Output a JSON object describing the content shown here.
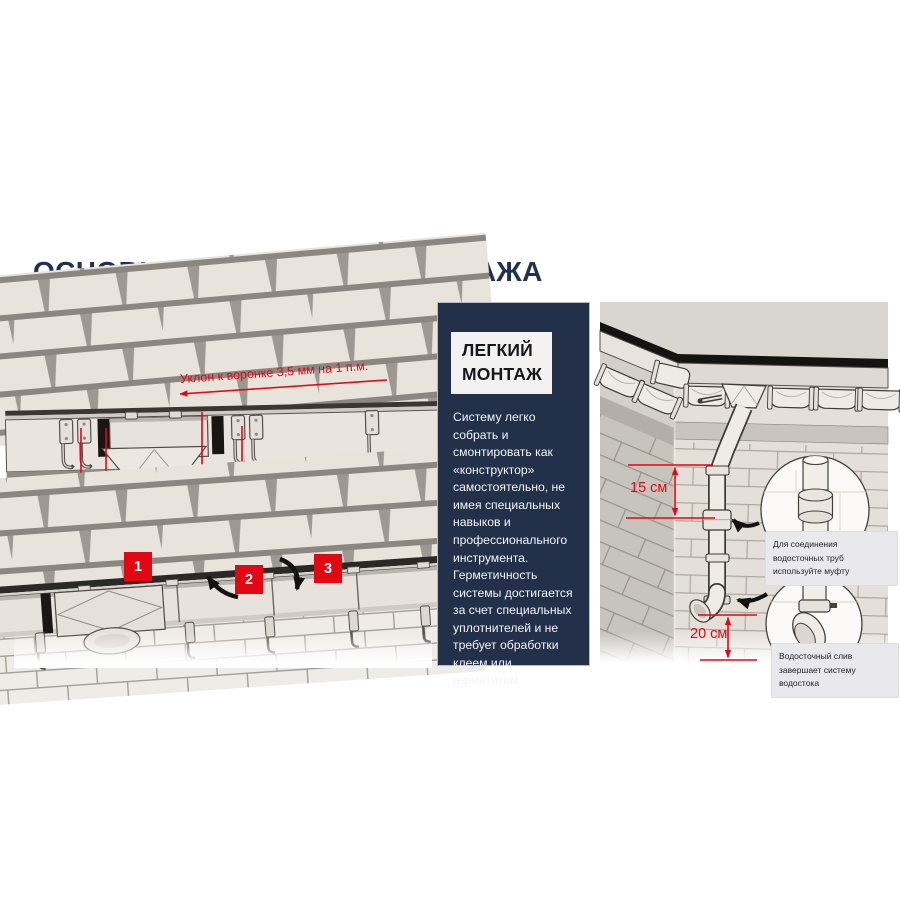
{
  "page": {
    "title": "ОСНОВНЫЕ ПРИНЦИПЫ МОНТАЖА"
  },
  "colors": {
    "accent_red": "#e30613",
    "navy": "#22304a",
    "panel_gray": "#a7a29c"
  },
  "panels": {
    "slope": {
      "slope_note": "Уклон к воронке 3,5 мм на 1 п.м.",
      "dim_left": "10 см",
      "dim_right": "10 см"
    },
    "assembly": {
      "steps": [
        "1",
        "2",
        "3"
      ]
    },
    "easy": {
      "heading_line1": "ЛЕГКИЙ",
      "heading_line2": "МОНТАЖ",
      "body": "Систему легко собрать и смонтировать как «конструктор» самостоятельно, не имея специальных навыков и профессионального инструмента. Герметичность системы достигается за счет специальных уплотнителей и не требует обработки клеем или герметиком."
    },
    "downpipe": {
      "dim_upper": "15 см",
      "dim_lower": "20 см",
      "callout_coupling": "Для соединения водосточных труб используйте муфту",
      "callout_outlet": "Водосточный слив завершает систему водостока"
    }
  }
}
